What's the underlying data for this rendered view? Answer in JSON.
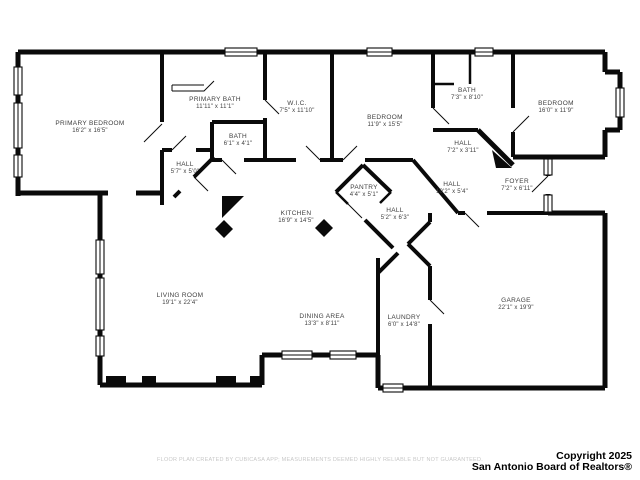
{
  "colors": {
    "wall": "#0a0a0a",
    "background": "#ffffff",
    "label_text": "#3f3f3f",
    "disclaimer_text": "#c8c8c8",
    "copyright_text": "#000000"
  },
  "rooms": [
    {
      "name": "PRIMARY BEDROOM",
      "dims": "16'2\" x 16'5\"",
      "x": 90,
      "y": 128
    },
    {
      "name": "PRIMARY BATH",
      "dims": "11'11\" x 11'1\"",
      "x": 215,
      "y": 104
    },
    {
      "name": "W.I.C.",
      "dims": "7'5\" x 11'10\"",
      "x": 297,
      "y": 108
    },
    {
      "name": "BATH",
      "dims": "6'1\" x 4'1\"",
      "x": 238,
      "y": 141
    },
    {
      "name": "HALL",
      "dims": "5'7\" x 5'0\"",
      "x": 185,
      "y": 169
    },
    {
      "name": "BEDROOM",
      "dims": "11'9\" x 15'5\"",
      "x": 385,
      "y": 122
    },
    {
      "name": "BATH",
      "dims": "7'3\" x 8'10\"",
      "x": 467,
      "y": 95
    },
    {
      "name": "BEDROOM",
      "dims": "16'0\" x 11'9\"",
      "x": 556,
      "y": 108
    },
    {
      "name": "HALL",
      "dims": "7'2\" x 3'11\"",
      "x": 463,
      "y": 148
    },
    {
      "name": "HALL",
      "dims": "10'2\" x 5'4\"",
      "x": 452,
      "y": 189
    },
    {
      "name": "FOYER",
      "dims": "7'2\" x 6'11\"",
      "x": 517,
      "y": 186
    },
    {
      "name": "PANTRY",
      "dims": "4'4\" x 5'1\"",
      "x": 364,
      "y": 192
    },
    {
      "name": "KITCHEN",
      "dims": "16'9\" x 14'5\"",
      "x": 296,
      "y": 218
    },
    {
      "name": "HALL",
      "dims": "5'2\" x 6'3\"",
      "x": 395,
      "y": 215
    },
    {
      "name": "LIVING ROOM",
      "dims": "19'1\" x 22'4\"",
      "x": 180,
      "y": 300
    },
    {
      "name": "DINING AREA",
      "dims": "13'3\" x 8'11\"",
      "x": 322,
      "y": 321
    },
    {
      "name": "LAUNDRY",
      "dims": "6'0\" x 14'8\"",
      "x": 404,
      "y": 322
    },
    {
      "name": "GARAGE",
      "dims": "22'1\" x 19'9\"",
      "x": 516,
      "y": 305
    }
  ],
  "footer": {
    "disclaimer": "FLOOR PLAN CREATED BY CUBICASA APP; MEASUREMENTS DEEMED HIGHLY RELIABLE BUT NOT GUARANTEED.",
    "copyright_line1": "Copyright 2025",
    "copyright_line2": "San Antonio Board of Realtors®"
  }
}
